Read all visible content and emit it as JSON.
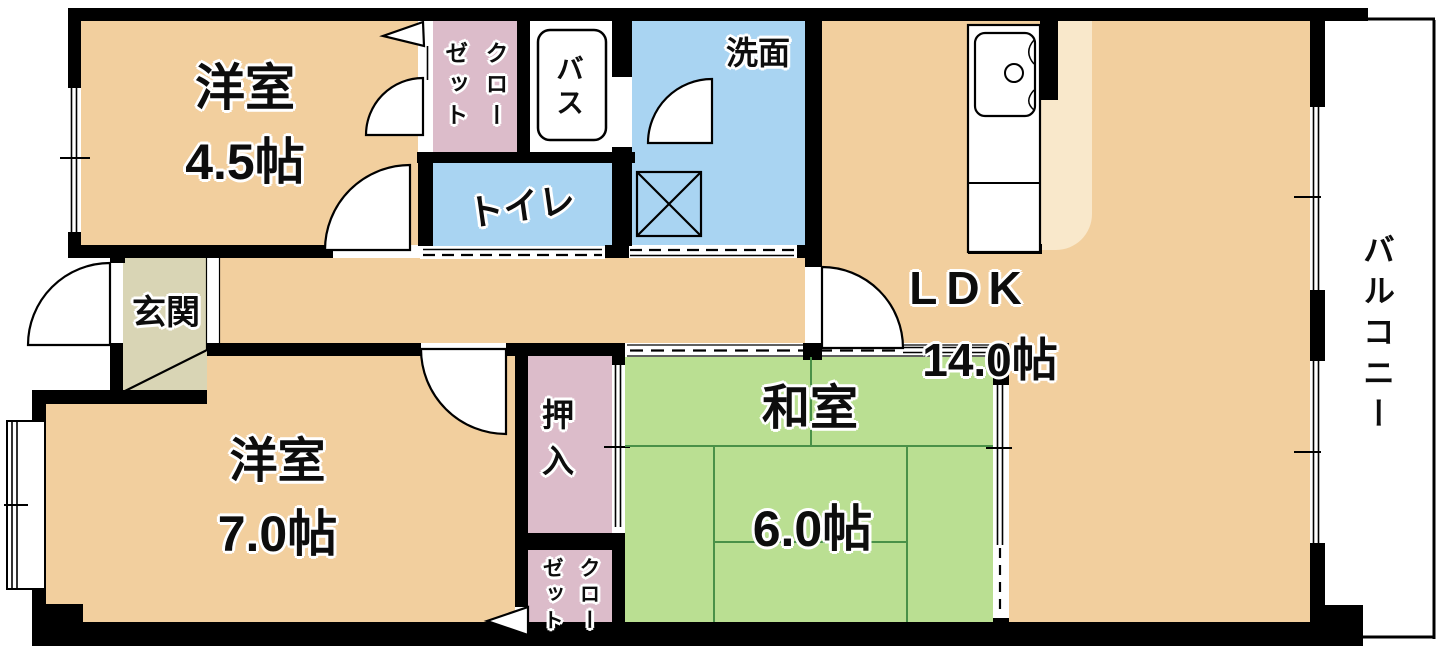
{
  "plan": {
    "rooms": {
      "western_4_5": {
        "name": "洋室",
        "size": "4.5帖"
      },
      "western_7_0": {
        "name": "洋室",
        "size": "7.0帖"
      },
      "japanese_6_0": {
        "name": "和室",
        "size": "6.0帖"
      },
      "ldk": {
        "name": "LDK",
        "size": "14.0帖"
      },
      "entrance": {
        "name": "玄関"
      },
      "bath": {
        "name": "バス"
      },
      "washroom": {
        "name": "洗面"
      },
      "toilet": {
        "name": "トイレ"
      },
      "closet_top": {
        "name": "クローゼット",
        "col1": "クロー",
        "col2": "ゼット"
      },
      "closet_bottom": {
        "name": "クローゼット",
        "col1": "クロー",
        "col2": "ゼット"
      },
      "oshiire": {
        "name": "押入"
      },
      "balcony": {
        "name": "バルコニー"
      }
    },
    "colors": {
      "wall": "#000000",
      "room_beige": "#f2cf9e",
      "kitchen_beige": "#f9e8cb",
      "tatami_green": "#badf92",
      "tatami_line": "#4a9148",
      "water_blue": "#a9d4f2",
      "closet_pink": "#dcbcca",
      "entrance_gray": "#d9d5b5"
    }
  }
}
